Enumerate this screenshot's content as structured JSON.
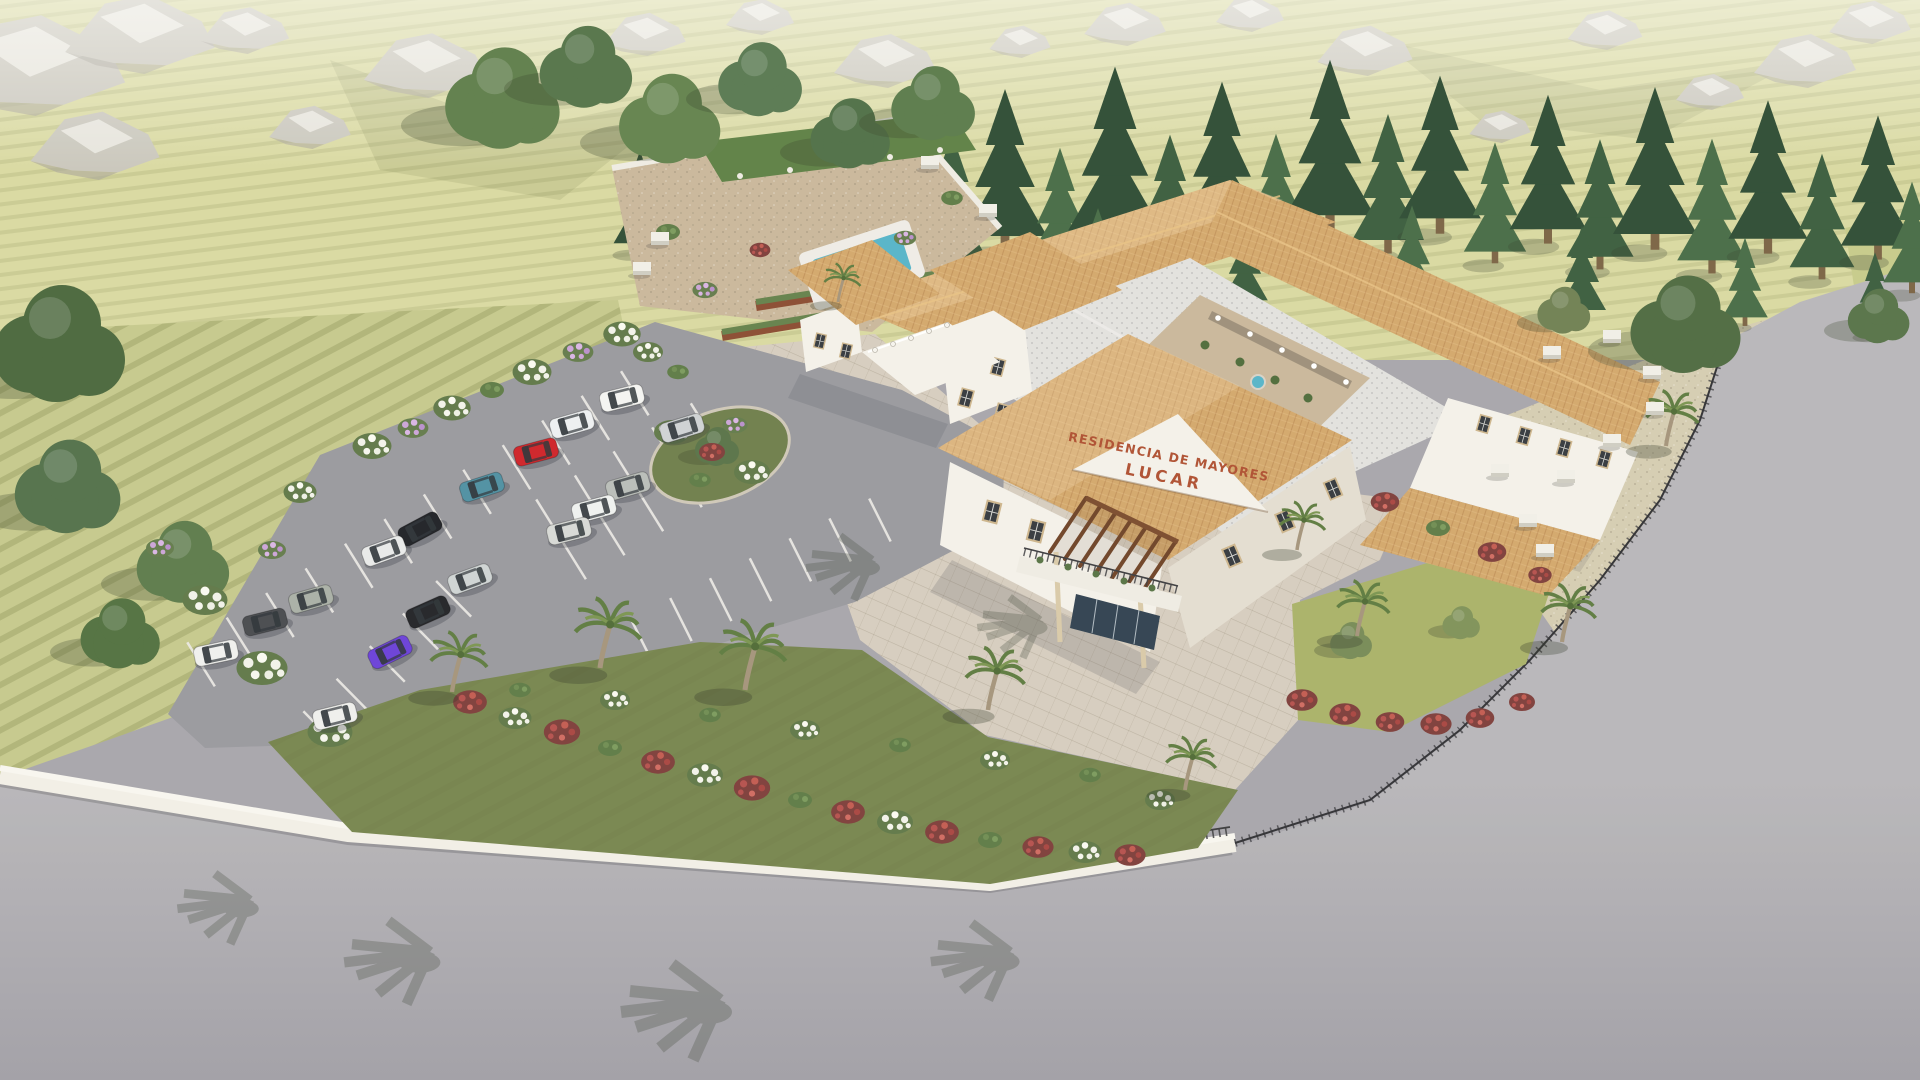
{
  "sign": {
    "line1": "RESIDENCIA DE MAYORES",
    "line2": "LUCAR",
    "color": "#ae4f30"
  },
  "palette": {
    "hills": "#d9d9a1",
    "farmland": "#c5c88c",
    "grass_strip": "#c6ca8a",
    "asphalt": "#98989e",
    "road_light": "#b8b6ba",
    "road_dark": "#a19fa6",
    "wall": "#f2efe7",
    "roof_terracotta": "#d3a76b",
    "roof_gray": "#e2e1de",
    "building_white": "#f4f1ea",
    "building_shade": "#e3ddd1",
    "stone_plaza": "#d6cdbf",
    "gravel": "#d5ccb1",
    "pool": "#55b4c8",
    "lawn": "#a9b168",
    "slope_green": "#76854e",
    "island_green": "#6e7d4a",
    "courtyard_floor": "#c9b79b",
    "pergola_vine": "#5d7f44",
    "window_dark": "#33383d"
  },
  "scene": {
    "cars": [
      {
        "x": 622,
        "y": 398,
        "a": -14,
        "c": "#f4f4f2"
      },
      {
        "x": 572,
        "y": 424,
        "a": -16,
        "c": "#eef0f2"
      },
      {
        "x": 536,
        "y": 452,
        "a": -15,
        "c": "#cf2127"
      },
      {
        "x": 482,
        "y": 487,
        "a": -18,
        "c": "#4e8fa2"
      },
      {
        "x": 420,
        "y": 529,
        "a": -28,
        "c": "#1e2025"
      },
      {
        "x": 384,
        "y": 551,
        "a": -20,
        "c": "#e9eaea"
      },
      {
        "x": 311,
        "y": 599,
        "a": -16,
        "c": "#a9afa6"
      },
      {
        "x": 265,
        "y": 622,
        "a": -14,
        "c": "#47494e"
      },
      {
        "x": 216,
        "y": 653,
        "a": -12,
        "c": "#f0f0ee"
      },
      {
        "x": 682,
        "y": 428,
        "a": -17,
        "c": "#cfd2d4"
      },
      {
        "x": 628,
        "y": 486,
        "a": -16,
        "c": "#b9bdb9"
      },
      {
        "x": 594,
        "y": 509,
        "a": -15,
        "c": "#eff1f0"
      },
      {
        "x": 569,
        "y": 531,
        "a": -14,
        "c": "#d7d9d6"
      },
      {
        "x": 470,
        "y": 579,
        "a": -20,
        "c": "#cfd4d4"
      },
      {
        "x": 428,
        "y": 612,
        "a": -24,
        "c": "#212226"
      },
      {
        "x": 390,
        "y": 652,
        "a": -26,
        "c": "#6a3fd8"
      },
      {
        "x": 335,
        "y": 716,
        "a": -14,
        "c": "#efefed"
      }
    ],
    "palms": [
      {
        "x": 838,
        "y": 302,
        "s": 0.8
      },
      {
        "x": 452,
        "y": 692,
        "s": 1.25
      },
      {
        "x": 600,
        "y": 668,
        "s": 1.45
      },
      {
        "x": 745,
        "y": 690,
        "s": 1.45
      },
      {
        "x": 988,
        "y": 710,
        "s": 1.3
      },
      {
        "x": 1185,
        "y": 790,
        "s": 1.1
      },
      {
        "x": 1297,
        "y": 550,
        "s": 1.0
      },
      {
        "x": 1357,
        "y": 636,
        "s": 1.15
      },
      {
        "x": 1666,
        "y": 446,
        "s": 1.15
      },
      {
        "x": 1562,
        "y": 642,
        "s": 1.2
      }
    ],
    "pines": [
      {
        "x": 640,
        "y": 252,
        "s": 1.1,
        "c": "#2d4b33"
      },
      {
        "x": 692,
        "y": 232,
        "s": 1.35,
        "c": "#3a5c3d"
      },
      {
        "x": 746,
        "y": 258,
        "s": 1.0,
        "c": "#2d4b33"
      },
      {
        "x": 952,
        "y": 272,
        "s": 1.5,
        "c": "#3a5c3d"
      },
      {
        "x": 1005,
        "y": 250,
        "s": 1.75,
        "c": "#2d4b33"
      },
      {
        "x": 1060,
        "y": 272,
        "s": 1.35,
        "c": "#466b45"
      },
      {
        "x": 1115,
        "y": 246,
        "s": 1.95,
        "c": "#2d4b33"
      },
      {
        "x": 1170,
        "y": 268,
        "s": 1.45,
        "c": "#3a5c3d"
      },
      {
        "x": 1222,
        "y": 238,
        "s": 1.7,
        "c": "#2d4b33"
      },
      {
        "x": 1276,
        "y": 258,
        "s": 1.35,
        "c": "#466b45"
      },
      {
        "x": 1330,
        "y": 230,
        "s": 1.85,
        "c": "#2d4b33"
      },
      {
        "x": 1388,
        "y": 252,
        "s": 1.5,
        "c": "#3a5c3d"
      },
      {
        "x": 1440,
        "y": 232,
        "s": 1.7,
        "c": "#2d4b33"
      },
      {
        "x": 1495,
        "y": 262,
        "s": 1.3,
        "c": "#466b45"
      },
      {
        "x": 1548,
        "y": 242,
        "s": 1.6,
        "c": "#2d4b33"
      },
      {
        "x": 1600,
        "y": 268,
        "s": 1.4,
        "c": "#3a5c3d"
      },
      {
        "x": 1655,
        "y": 248,
        "s": 1.75,
        "c": "#2d4b33"
      },
      {
        "x": 1712,
        "y": 272,
        "s": 1.45,
        "c": "#466b45"
      },
      {
        "x": 1768,
        "y": 252,
        "s": 1.65,
        "c": "#2d4b33"
      },
      {
        "x": 1822,
        "y": 278,
        "s": 1.35,
        "c": "#3a5c3d"
      },
      {
        "x": 1878,
        "y": 258,
        "s": 1.55,
        "c": "#2d4b33"
      },
      {
        "x": 1912,
        "y": 292,
        "s": 1.2,
        "c": "#466b45"
      },
      {
        "x": 1098,
        "y": 300,
        "s": 1.0,
        "c": "#466b45"
      },
      {
        "x": 1245,
        "y": 308,
        "s": 0.95,
        "c": "#3a5c3d"
      },
      {
        "x": 1412,
        "y": 302,
        "s": 1.05,
        "c": "#466b45"
      },
      {
        "x": 1582,
        "y": 318,
        "s": 1.0,
        "c": "#3a5c3d"
      },
      {
        "x": 1745,
        "y": 325,
        "s": 0.95,
        "c": "#466b45"
      },
      {
        "x": 1875,
        "y": 335,
        "s": 0.9,
        "c": "#3a5c3d"
      }
    ],
    "trees": [
      {
        "x": 505,
        "y": 102,
        "s": 2.6,
        "c": "#5e7d4a"
      },
      {
        "x": 588,
        "y": 70,
        "s": 2.1,
        "c": "#547348"
      },
      {
        "x": 672,
        "y": 122,
        "s": 2.3,
        "c": "#62824d"
      },
      {
        "x": 762,
        "y": 82,
        "s": 1.9,
        "c": "#587851"
      },
      {
        "x": 852,
        "y": 136,
        "s": 1.8,
        "c": "#4f6f46"
      },
      {
        "x": 935,
        "y": 106,
        "s": 1.9,
        "c": "#5a7a4a"
      },
      {
        "x": 62,
        "y": 348,
        "s": 3.0,
        "c": "#49663c"
      },
      {
        "x": 70,
        "y": 490,
        "s": 2.4,
        "c": "#527049"
      },
      {
        "x": 185,
        "y": 565,
        "s": 2.1,
        "c": "#5c7a4a"
      },
      {
        "x": 122,
        "y": 636,
        "s": 1.8,
        "c": "#51703f"
      },
      {
        "x": 1565,
        "y": 312,
        "s": 1.2,
        "c": "#6f7f52"
      },
      {
        "x": 1688,
        "y": 328,
        "s": 2.5,
        "c": "#4e6a40"
      },
      {
        "x": 1352,
        "y": 642,
        "s": 0.95,
        "c": "#768a56"
      },
      {
        "x": 1462,
        "y": 624,
        "s": 0.85,
        "c": "#7e9158"
      },
      {
        "x": 1880,
        "y": 318,
        "s": 1.4,
        "c": "#567247"
      },
      {
        "x": 718,
        "y": 448,
        "s": 1.0,
        "c": "#587247"
      }
    ],
    "shrubs": [
      {
        "x": 372,
        "y": 446,
        "s": 1.3,
        "t": "w"
      },
      {
        "x": 413,
        "y": 428,
        "s": 1.1,
        "t": "p"
      },
      {
        "x": 452,
        "y": 408,
        "s": 1.25,
        "t": "w"
      },
      {
        "x": 492,
        "y": 390,
        "s": 1.0,
        "t": "g"
      },
      {
        "x": 532,
        "y": 372,
        "s": 1.3,
        "t": "w"
      },
      {
        "x": 578,
        "y": 352,
        "s": 1.1,
        "t": "p"
      },
      {
        "x": 622,
        "y": 334,
        "s": 1.25,
        "t": "w"
      },
      {
        "x": 300,
        "y": 492,
        "s": 1.1,
        "t": "w"
      },
      {
        "x": 272,
        "y": 550,
        "s": 1.0,
        "t": "p"
      },
      {
        "x": 205,
        "y": 600,
        "s": 1.5,
        "t": "w"
      },
      {
        "x": 262,
        "y": 668,
        "s": 1.7,
        "t": "w"
      },
      {
        "x": 330,
        "y": 732,
        "s": 1.5,
        "t": "w"
      },
      {
        "x": 160,
        "y": 548,
        "s": 1.0,
        "t": "p"
      },
      {
        "x": 672,
        "y": 432,
        "s": 1.2,
        "t": "w"
      },
      {
        "x": 712,
        "y": 452,
        "s": 1.0,
        "t": "r"
      },
      {
        "x": 752,
        "y": 472,
        "s": 1.2,
        "t": "w"
      },
      {
        "x": 700,
        "y": 480,
        "s": 0.9,
        "t": "g"
      },
      {
        "x": 735,
        "y": 425,
        "s": 0.9,
        "t": "p"
      },
      {
        "x": 1385,
        "y": 502,
        "s": 1.1,
        "t": "r"
      },
      {
        "x": 1438,
        "y": 528,
        "s": 1.0,
        "t": "g"
      },
      {
        "x": 1492,
        "y": 552,
        "s": 1.1,
        "t": "r"
      },
      {
        "x": 1540,
        "y": 575,
        "s": 0.9,
        "t": "r"
      },
      {
        "x": 1302,
        "y": 700,
        "s": 1.2,
        "t": "r"
      },
      {
        "x": 1345,
        "y": 714,
        "s": 1.2,
        "t": "r"
      },
      {
        "x": 1390,
        "y": 722,
        "s": 1.1,
        "t": "r"
      },
      {
        "x": 1436,
        "y": 724,
        "s": 1.2,
        "t": "r"
      },
      {
        "x": 1480,
        "y": 718,
        "s": 1.1,
        "t": "r"
      },
      {
        "x": 1522,
        "y": 702,
        "s": 1.0,
        "t": "r"
      },
      {
        "x": 470,
        "y": 702,
        "s": 1.3,
        "t": "r"
      },
      {
        "x": 515,
        "y": 718,
        "s": 1.1,
        "t": "w"
      },
      {
        "x": 562,
        "y": 732,
        "s": 1.4,
        "t": "r"
      },
      {
        "x": 610,
        "y": 748,
        "s": 1.0,
        "t": "g"
      },
      {
        "x": 658,
        "y": 762,
        "s": 1.3,
        "t": "r"
      },
      {
        "x": 705,
        "y": 775,
        "s": 1.2,
        "t": "w"
      },
      {
        "x": 752,
        "y": 788,
        "s": 1.4,
        "t": "r"
      },
      {
        "x": 800,
        "y": 800,
        "s": 1.0,
        "t": "g"
      },
      {
        "x": 848,
        "y": 812,
        "s": 1.3,
        "t": "r"
      },
      {
        "x": 895,
        "y": 822,
        "s": 1.2,
        "t": "w"
      },
      {
        "x": 942,
        "y": 832,
        "s": 1.3,
        "t": "r"
      },
      {
        "x": 990,
        "y": 840,
        "s": 1.0,
        "t": "g"
      },
      {
        "x": 1038,
        "y": 847,
        "s": 1.2,
        "t": "r"
      },
      {
        "x": 1085,
        "y": 852,
        "s": 1.1,
        "t": "w"
      },
      {
        "x": 1130,
        "y": 855,
        "s": 1.2,
        "t": "r"
      },
      {
        "x": 520,
        "y": 690,
        "s": 0.9,
        "t": "g"
      },
      {
        "x": 615,
        "y": 700,
        "s": 1.0,
        "t": "w"
      },
      {
        "x": 710,
        "y": 715,
        "s": 0.9,
        "t": "g"
      },
      {
        "x": 805,
        "y": 730,
        "s": 1.0,
        "t": "w"
      },
      {
        "x": 900,
        "y": 745,
        "s": 0.9,
        "t": "g"
      },
      {
        "x": 995,
        "y": 760,
        "s": 1.0,
        "t": "w"
      },
      {
        "x": 1090,
        "y": 775,
        "s": 0.9,
        "t": "g"
      },
      {
        "x": 1160,
        "y": 800,
        "s": 1.0,
        "t": "w"
      },
      {
        "x": 668,
        "y": 232,
        "s": 1.0,
        "t": "g"
      },
      {
        "x": 705,
        "y": 290,
        "s": 0.9,
        "t": "p"
      },
      {
        "x": 952,
        "y": 198,
        "s": 0.9,
        "t": "g"
      },
      {
        "x": 760,
        "y": 250,
        "s": 0.8,
        "t": "r"
      },
      {
        "x": 905,
        "y": 238,
        "s": 0.8,
        "t": "p"
      },
      {
        "x": 648,
        "y": 352,
        "s": 1.0,
        "t": "w"
      },
      {
        "x": 678,
        "y": 372,
        "s": 0.9,
        "t": "g"
      }
    ],
    "benches": [
      {
        "x": 1552,
        "y": 352
      },
      {
        "x": 1612,
        "y": 336
      },
      {
        "x": 1652,
        "y": 372
      },
      {
        "x": 1655,
        "y": 408
      },
      {
        "x": 1612,
        "y": 440
      },
      {
        "x": 1566,
        "y": 476
      },
      {
        "x": 1528,
        "y": 520
      },
      {
        "x": 1545,
        "y": 550
      },
      {
        "x": 1500,
        "y": 470
      },
      {
        "x": 660,
        "y": 238
      },
      {
        "x": 642,
        "y": 268
      },
      {
        "x": 930,
        "y": 162
      },
      {
        "x": 988,
        "y": 210
      }
    ],
    "rocks": [
      {
        "x": 30,
        "y": 60,
        "s": 2.8
      },
      {
        "x": 140,
        "y": 30,
        "s": 2.2
      },
      {
        "x": 95,
        "y": 142,
        "s": 1.9
      },
      {
        "x": 245,
        "y": 28,
        "s": 1.3
      },
      {
        "x": 425,
        "y": 62,
        "s": 1.8
      },
      {
        "x": 645,
        "y": 32,
        "s": 1.2
      },
      {
        "x": 885,
        "y": 58,
        "s": 1.5
      },
      {
        "x": 1125,
        "y": 22,
        "s": 1.2
      },
      {
        "x": 1365,
        "y": 48,
        "s": 1.4
      },
      {
        "x": 1605,
        "y": 28,
        "s": 1.1
      },
      {
        "x": 1805,
        "y": 58,
        "s": 1.5
      },
      {
        "x": 760,
        "y": 15,
        "s": 1.0
      },
      {
        "x": 1020,
        "y": 40,
        "s": 0.9
      },
      {
        "x": 1250,
        "y": 12,
        "s": 1.0
      },
      {
        "x": 1710,
        "y": 90,
        "s": 1.0
      },
      {
        "x": 1870,
        "y": 20,
        "s": 1.2
      },
      {
        "x": 310,
        "y": 125,
        "s": 1.2
      },
      {
        "x": 1500,
        "y": 125,
        "s": 0.9
      }
    ],
    "road_shadows": [
      {
        "x": 430,
        "y": 952,
        "s": 2.6
      },
      {
        "x": 720,
        "y": 1000,
        "s": 3.0
      },
      {
        "x": 1010,
        "y": 952,
        "s": 2.4
      },
      {
        "x": 250,
        "y": 900,
        "s": 2.2
      },
      {
        "x": 872,
        "y": 560,
        "s": 2.0
      },
      {
        "x": 1040,
        "y": 620,
        "s": 1.9
      }
    ]
  }
}
